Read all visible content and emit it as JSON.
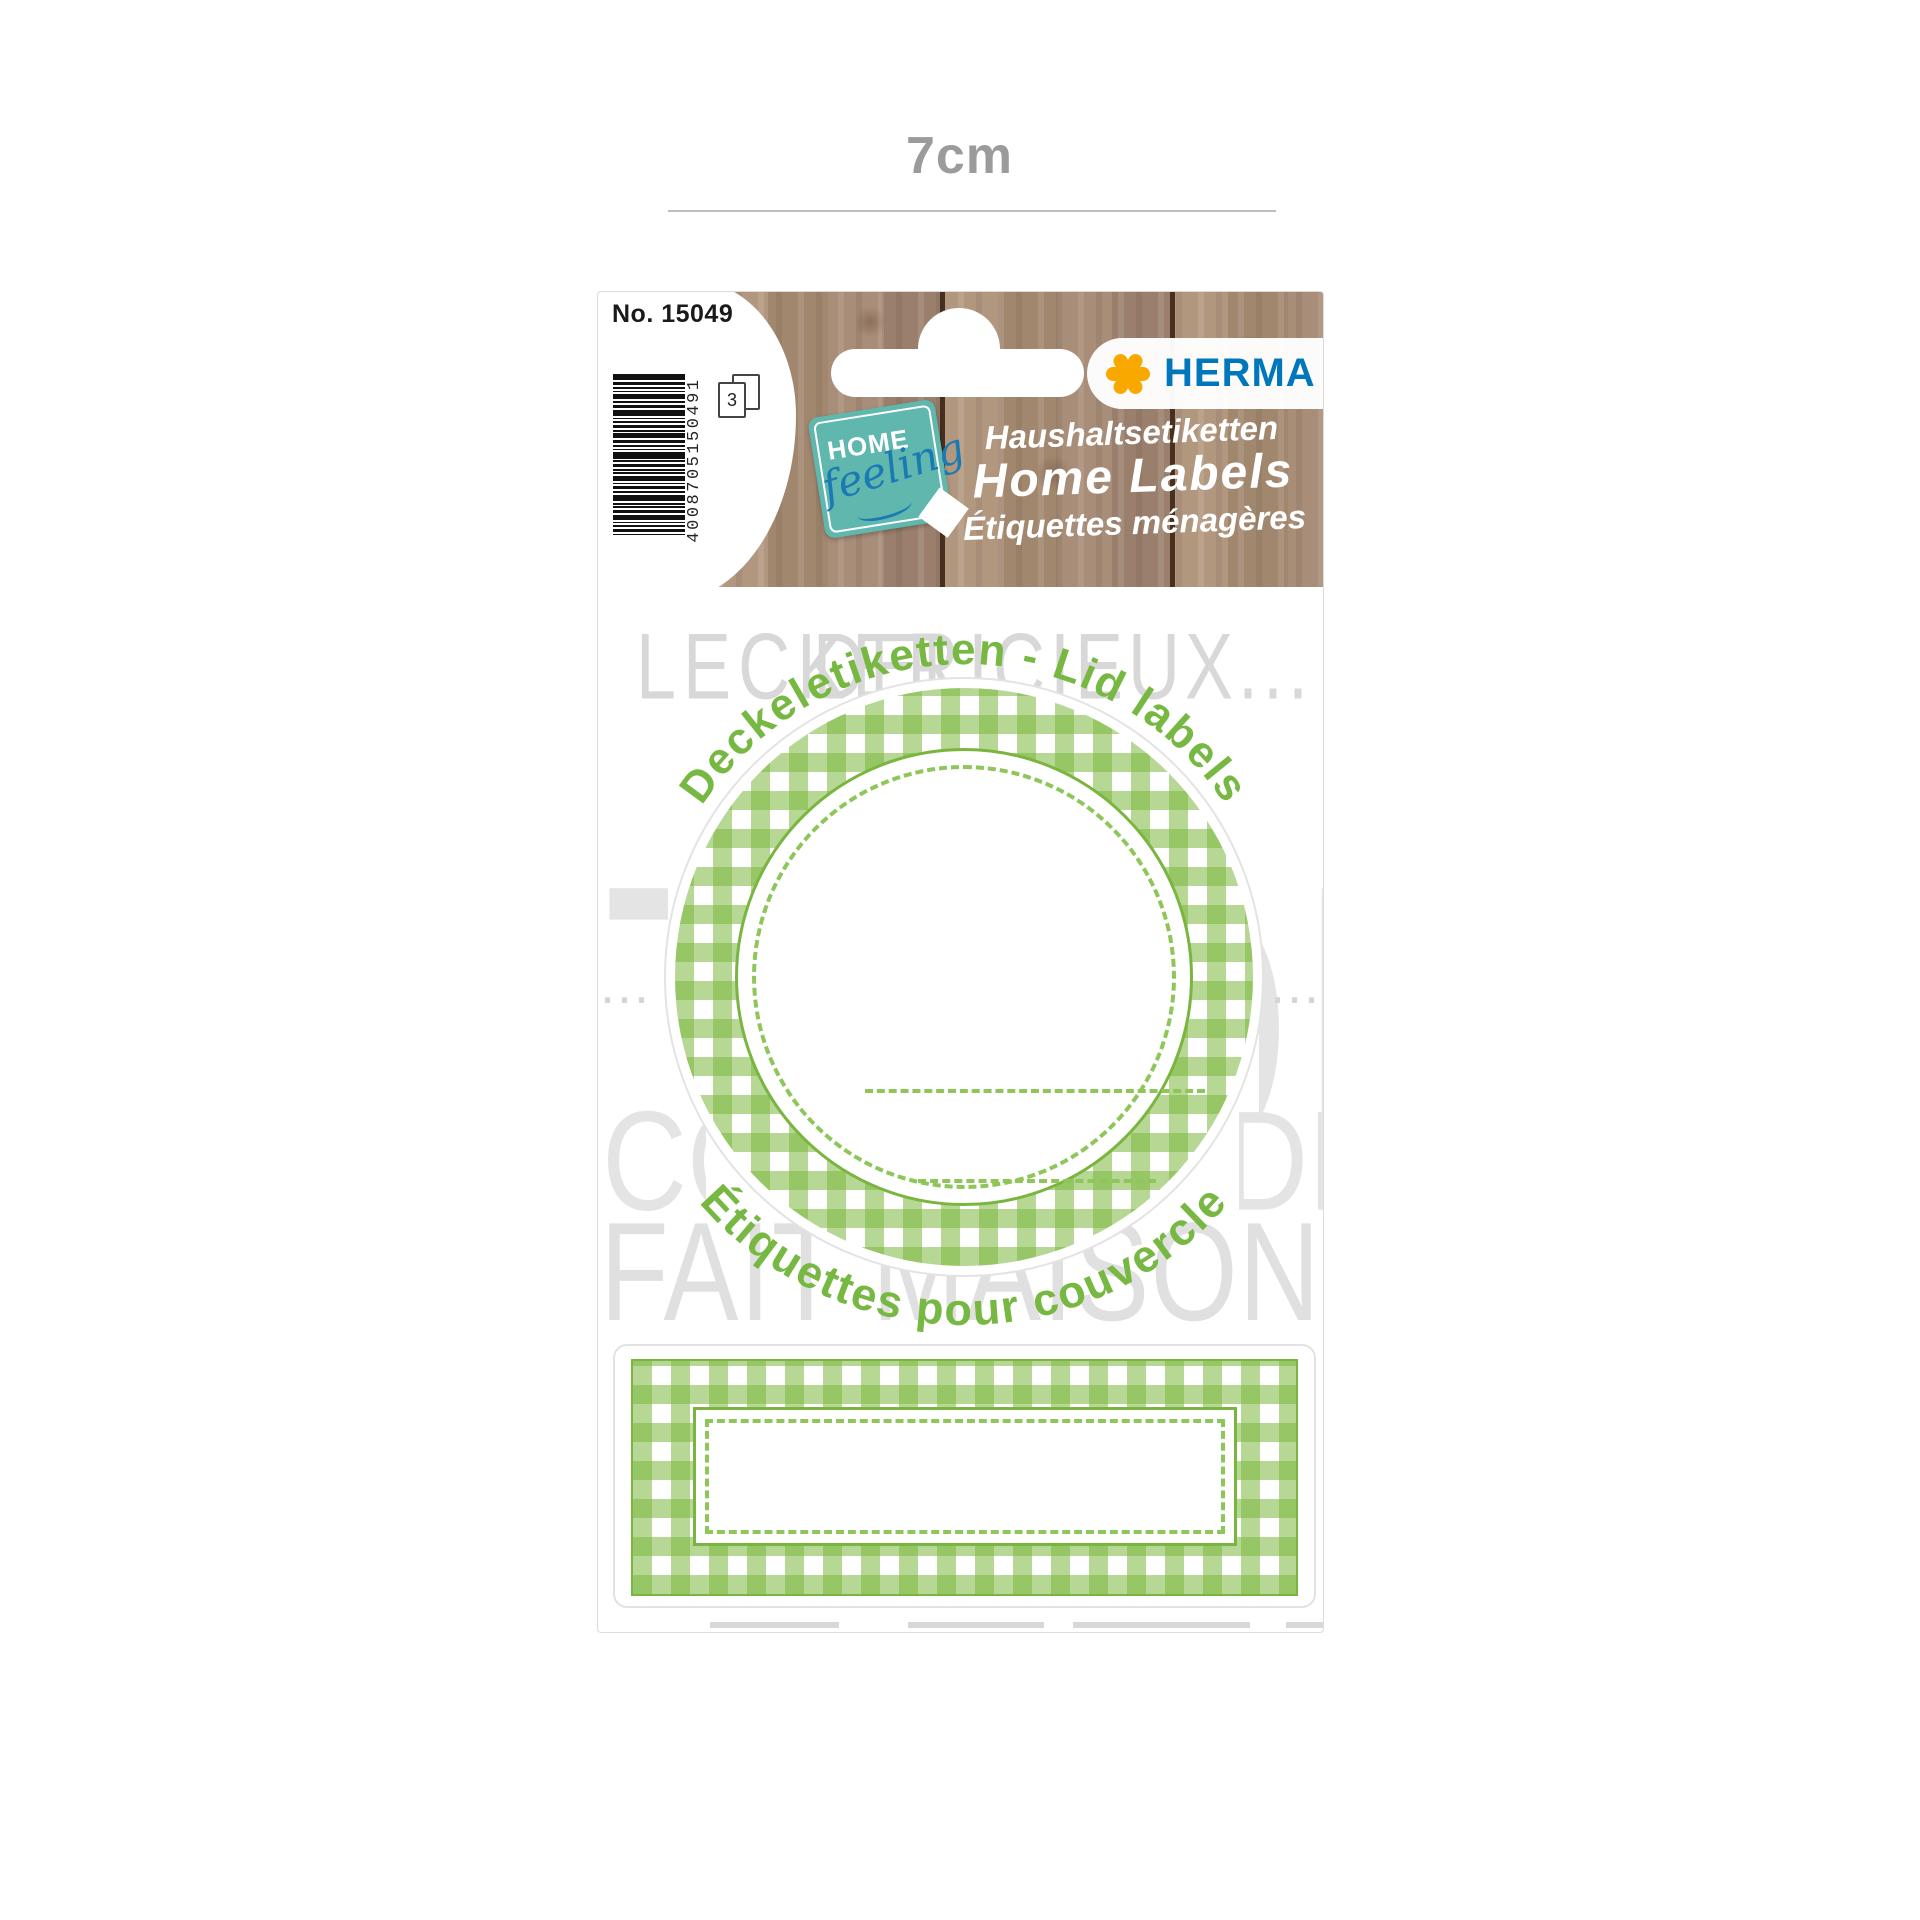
{
  "dimension": {
    "label": "7cm"
  },
  "package": {
    "product_no": "No. 15049",
    "sheet_count": "3",
    "barcode": {
      "digits": "4008705150491"
    },
    "brand": {
      "name": "HERMA"
    },
    "badge": {
      "line1": "HOME",
      "line2": "feeling"
    },
    "wood_titles": {
      "de": "Haushaltsetiketten",
      "en": "Home Labels",
      "fr": "Étiquettes ménagères"
    },
    "section": {
      "arc_top": "Deckeletiketten - Lid labels",
      "arc_bottom": "Étiquettes pour couvercle"
    },
    "background_words": {
      "top_left": "LECKER",
      "top_right": "DELICIEUX...",
      "mid_left_fragment": "TA",
      "mid_right_fragment": "ON",
      "lower_left_fragment": "CO",
      "lower_right_fragment": "DE",
      "dots_left": "...",
      "dots_right": "...",
      "bottom": "FAIT MAISON"
    },
    "colors": {
      "label_green": "#77b843",
      "gingham_green": "#7cb74a",
      "badge_teal": "#5fb7ae",
      "herma_blue": "#0076bd",
      "asterisk_yellow": "#f9a800"
    }
  }
}
